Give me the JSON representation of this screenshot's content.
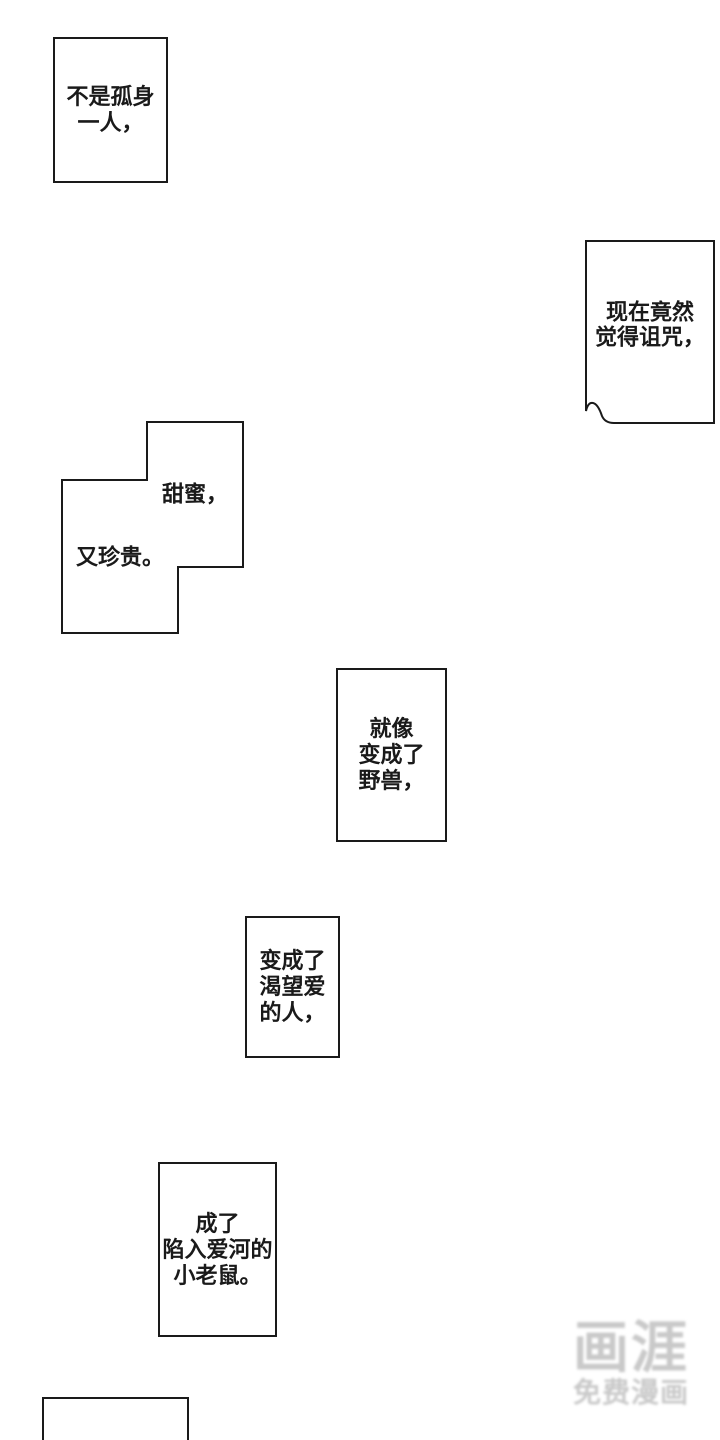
{
  "page": {
    "background_color": "#ffffff",
    "ink_color": "#1a1a1a",
    "watermark_color": "#c9c9c9"
  },
  "bubbles": {
    "b1": {
      "line1": "不是孤身",
      "line2": "一人，"
    },
    "b2": {
      "line1": "现在竟然",
      "line2": "觉得诅咒，"
    },
    "b3": {
      "text_top": "甜蜜，",
      "text_bottom": "又珍贵。"
    },
    "b4": {
      "line1": "就像",
      "line2": "变成了",
      "line3": "野兽，"
    },
    "b5": {
      "line1": "变成了",
      "line2": "渴望爱",
      "line3": "的人，"
    },
    "b6": {
      "line1": "成了",
      "line2": "陷入爱河的",
      "line3": "小老鼠。"
    }
  },
  "watermark": {
    "logo": "画涯",
    "subtitle": "免费漫画"
  }
}
